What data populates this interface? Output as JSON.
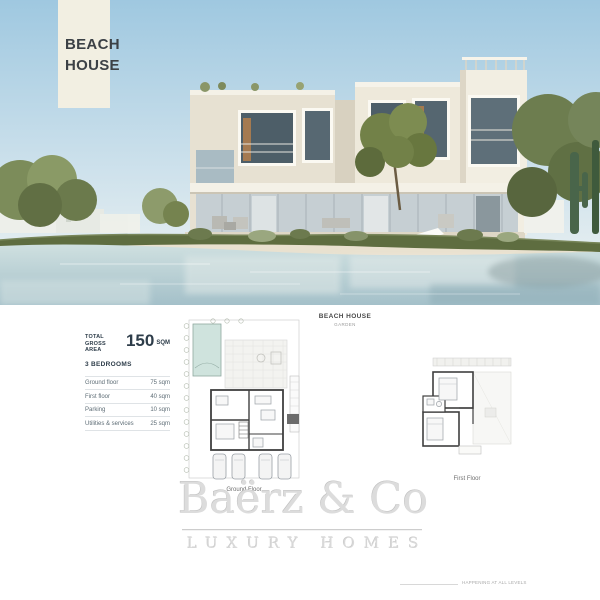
{
  "banner": {
    "line1": "BEACH",
    "line2": "HOUSE"
  },
  "specs": {
    "total_label_line1": "TOTAL",
    "total_label_line2": "GROSS AREA",
    "total_value": "150",
    "total_unit": "SQM",
    "bedrooms": "3 BEDROOMS",
    "rows": [
      {
        "label": "Ground floor",
        "value": "75 sqm"
      },
      {
        "label": "First floor",
        "value": "40 sqm"
      },
      {
        "label": "Parking",
        "value": "10 sqm"
      },
      {
        "label": "Utilities & services",
        "value": "25 sqm"
      }
    ]
  },
  "plans": {
    "title": "BEACH HOUSE",
    "subtitle": "GARDEN",
    "ground_caption": "Ground Floor",
    "first_caption": "First Floor"
  },
  "watermark": {
    "brand": "Baërz & Co",
    "tagline": "LUXURY HOMES"
  },
  "footnote": "HAPPENING AT ALL LEVELS",
  "colors": {
    "banner_bg": "#f2efe2",
    "sky": "#a5cde2",
    "water": "#b6d2d6",
    "sand": "#e9e1cf",
    "villa_wall": "#ece7d9",
    "glass": "#53646e",
    "pool": "#cfe3dd",
    "plan_wall": "#3f3f3f",
    "heading_text": "#2e3d4a",
    "watermark_gray": "#dcdcdc"
  }
}
